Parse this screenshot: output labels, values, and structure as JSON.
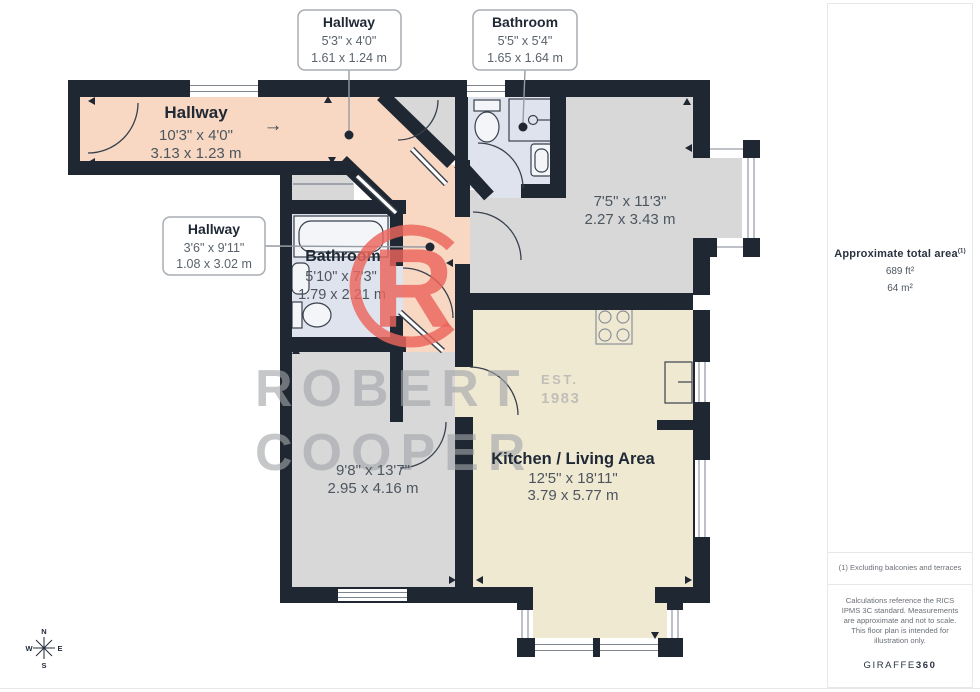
{
  "plan": {
    "callouts": [
      {
        "title": "Hallway",
        "imperial": "5'3\" x 4'0\"",
        "metric": "1.61 x 1.24 m"
      },
      {
        "title": "Bathroom",
        "imperial": "5'5\" x 5'4\"",
        "metric": "1.65 x 1.64 m"
      },
      {
        "title": "Hallway",
        "imperial": "3'6\" x 9'11\"",
        "metric": "1.08 x 3.02 m"
      }
    ],
    "rooms": [
      {
        "name": "Hallway",
        "imperial": "10'3\" x 4'0\"",
        "metric": "3.13 x 1.23 m"
      },
      {
        "name": "Bathroom",
        "imperial": "5'10\" x 7'3\"",
        "metric": "1.79 x 2.21 m"
      },
      {
        "name": "",
        "imperial": "7'5\" x 11'3\"",
        "metric": "2.27 x 3.43 m"
      },
      {
        "name": "",
        "imperial": "9'8\" x 13'7\"",
        "metric": "2.95 x 4.16 m"
      },
      {
        "name": "Kitchen / Living Area",
        "imperial": "12'5\" x 18'11\"",
        "metric": "3.79 x 5.77 m"
      }
    ],
    "arrow": "→"
  },
  "watermark": {
    "line1": "ROBERT",
    "line2": "COOPER",
    "est": "EST.",
    "year": "1983",
    "monogram": "R"
  },
  "sidebar": {
    "area_title": "Approximate total area",
    "area_superscript": "(1)",
    "area_ft": "689 ft²",
    "area_m": "64 m²",
    "footnote": "(1) Excluding balconies and terraces",
    "disclaimer": "Calculations reference the RICS IPMS 3C standard. Measurements are approximate and not to scale. This floor plan is intended for illustration only.",
    "brand": "GIRAFFE",
    "brand_bold": "360"
  },
  "compass": {
    "n": "N",
    "e": "E",
    "s": "S",
    "w": "W"
  },
  "colors": {
    "wall": "#1f2733",
    "hallway": "#f8d8c2",
    "room_gray": "#d8d8d9",
    "bathroom": "#dfe3ee",
    "kitchen": "#f0e9d2",
    "logo_coral": "#ec655c",
    "watermark_gray": "#a2a5a9"
  }
}
